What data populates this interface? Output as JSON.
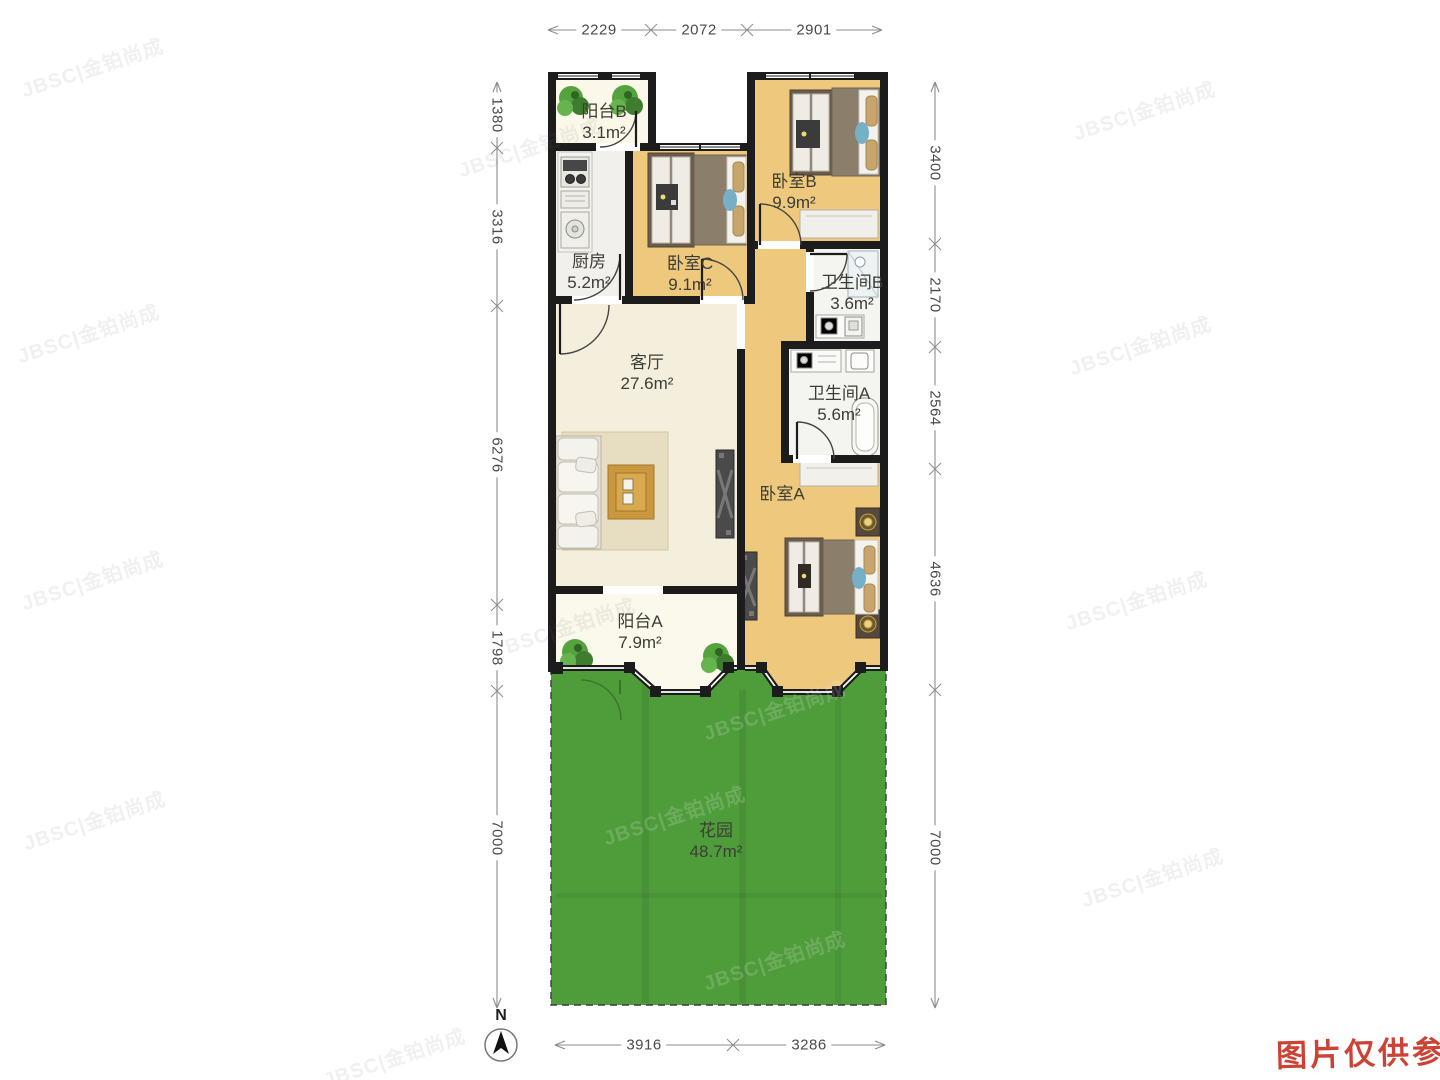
{
  "plan": {
    "rooms": [
      {
        "name": "阳台B",
        "area": "3.1m²"
      },
      {
        "name": "厨房",
        "area": "5.2m²"
      },
      {
        "name": "卧室C",
        "area": "9.1m²"
      },
      {
        "name": "卧室B",
        "area": "9.9m²"
      },
      {
        "name": "卫生间B",
        "area": "3.6m²"
      },
      {
        "name": "客厅",
        "area": "27.6m²"
      },
      {
        "name": "卫生间A",
        "area": "5.6m²"
      },
      {
        "name": "卧室A",
        "area": ""
      },
      {
        "name": "阳台A",
        "area": "7.9m²"
      },
      {
        "name": "花园",
        "area": "48.7m²"
      }
    ]
  },
  "dimensions": {
    "top": [
      "2229",
      "2072",
      "2901"
    ],
    "left": [
      "1380",
      "3316",
      "6276",
      "1798",
      "7000"
    ],
    "right": [
      "3400",
      "2170",
      "2564",
      "4636",
      "7000"
    ],
    "bottom": [
      "3916",
      "3286"
    ]
  },
  "compass": {
    "north_label": "N"
  },
  "watermark": {
    "text": "JBSC|金铂尚成"
  },
  "disclaimer": {
    "text": "图片仅供参考"
  },
  "colors": {
    "wall": "#1c1c1c",
    "wood_floor": "#edc87d",
    "living_floor": "#f4efdc",
    "tile_floor": "#f1f0ec",
    "balcony_floor": "#fbf8ea",
    "garden": "#4f9c3b",
    "disclaimer_red": "#cc4336"
  }
}
